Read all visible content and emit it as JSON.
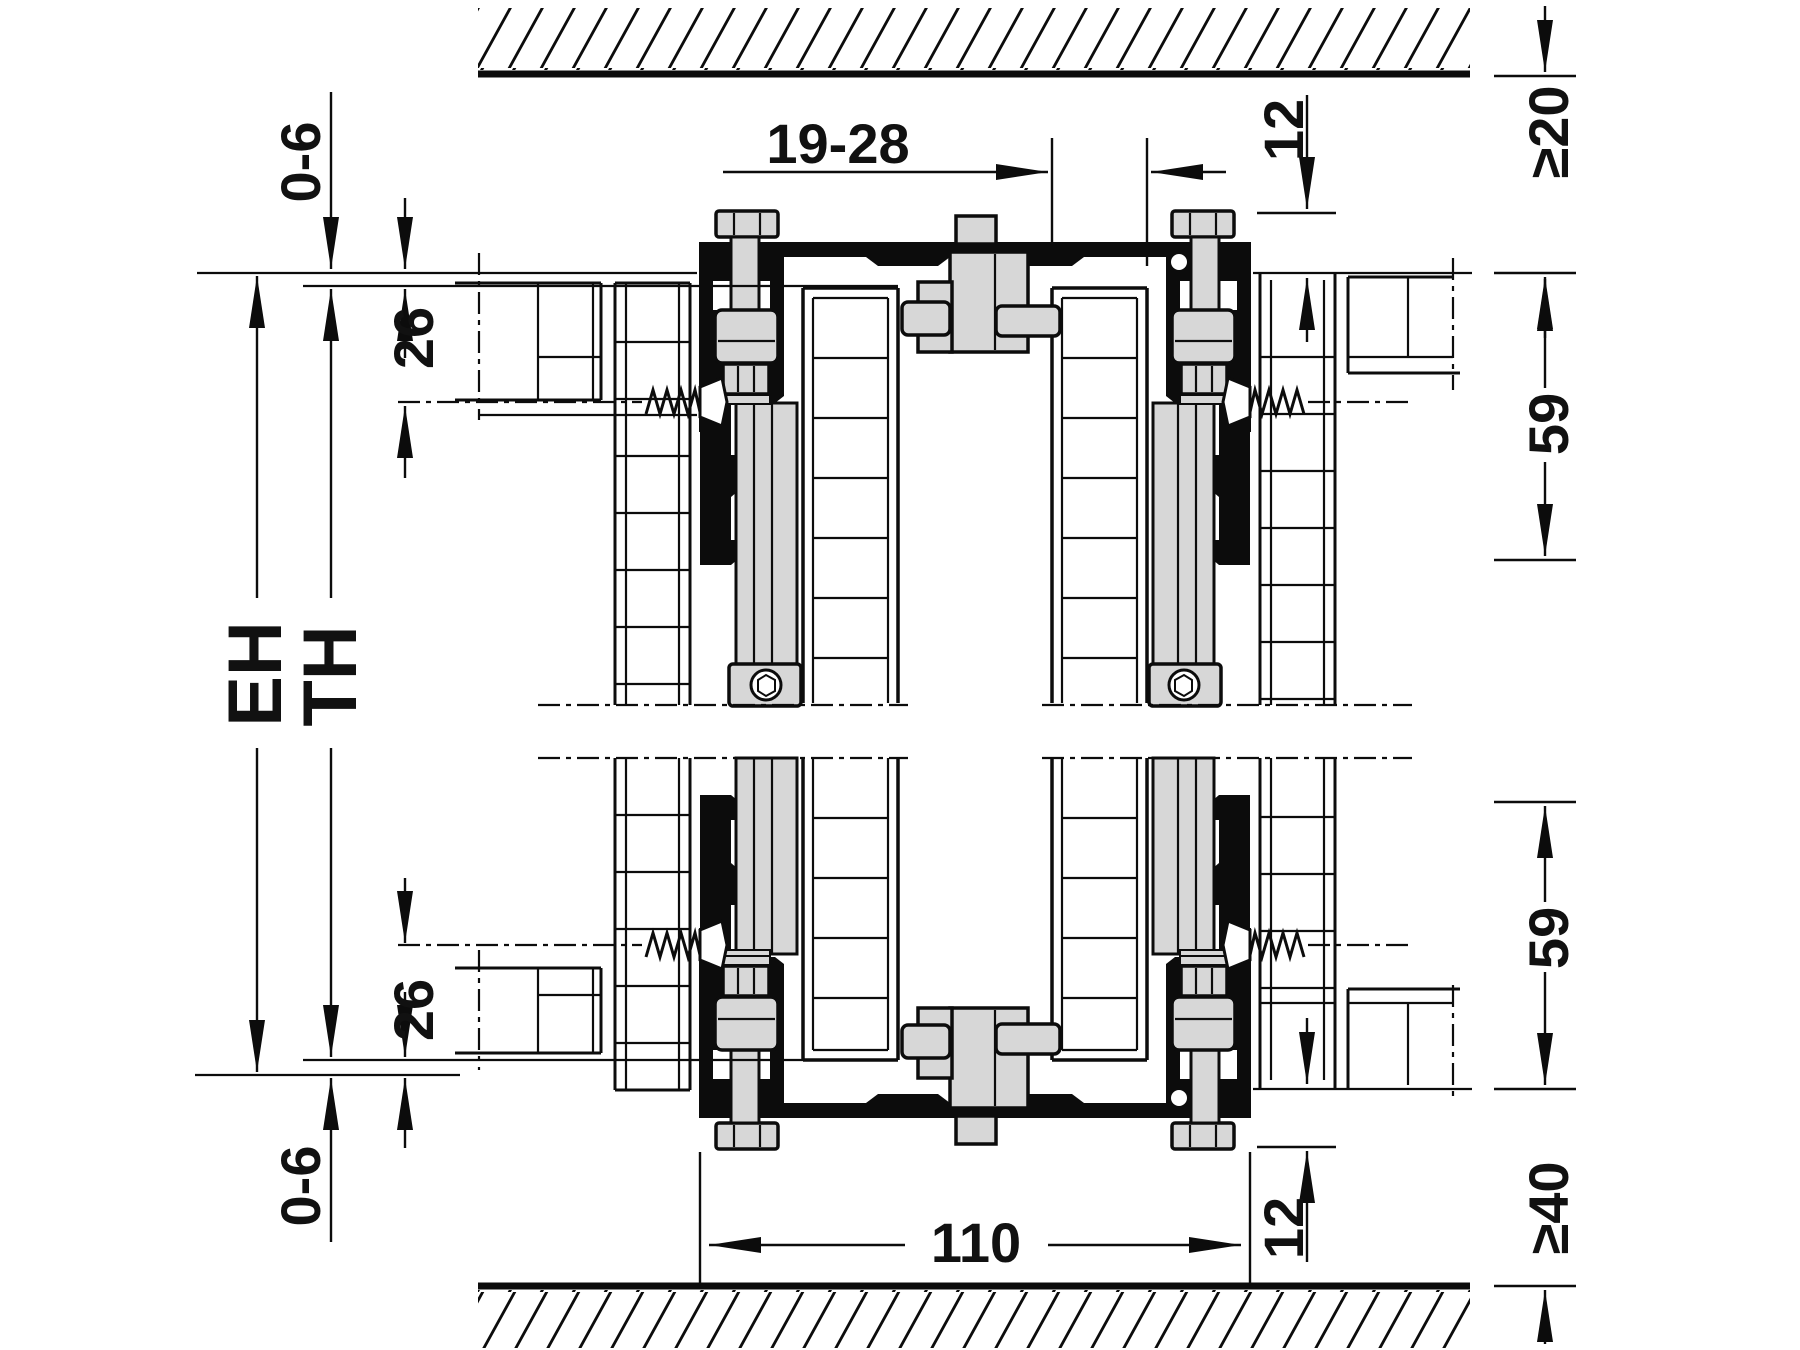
{
  "drawing": {
    "title": "sliding-door-fitting-vertical-cross-section",
    "colors": {
      "outline": "#0c0c0c",
      "metal_fill": "#d7d7d7",
      "background": "#ffffff",
      "label_text": "#111111"
    },
    "labels": {
      "top_gap": "0-6",
      "top_reveal": "26",
      "installation_height": "EH",
      "door_height": "TH",
      "door_thickness": "19-28",
      "top_inset": "12",
      "ceiling_clearance": "≥20",
      "upper_fitting_space": "59",
      "lower_fitting_space": "59",
      "bottom_inset": "12",
      "floor_clearance": "≥40",
      "track_width": "110",
      "bottom_reveal": "26",
      "bottom_gap": "0-6"
    }
  }
}
